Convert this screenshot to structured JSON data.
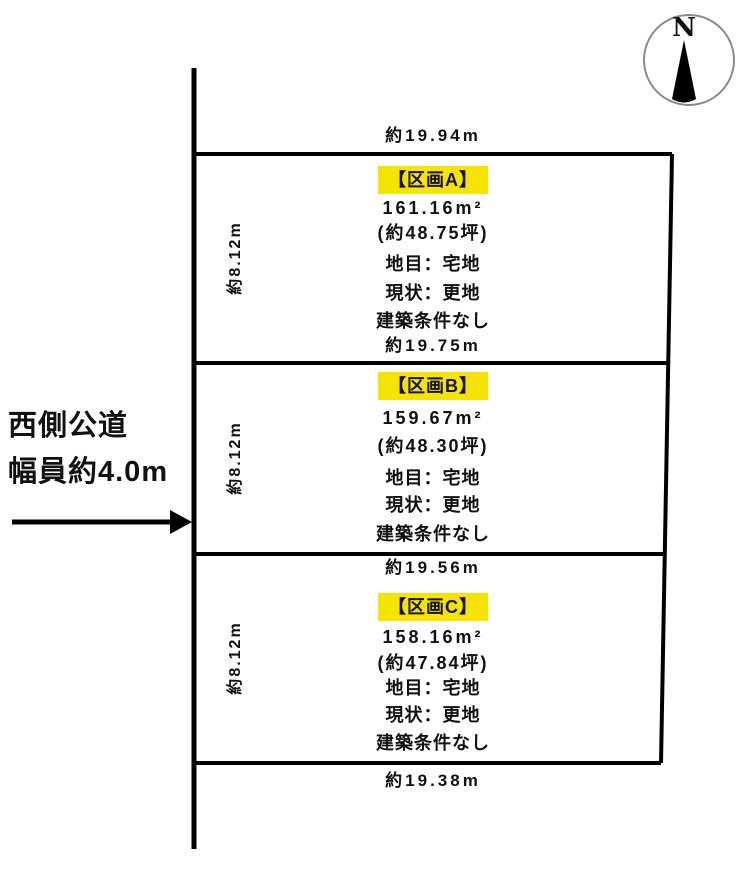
{
  "compass": {
    "label": "N"
  },
  "road": {
    "line1": "西側公道",
    "line2": "幅員約4.0m"
  },
  "frontage_top": "約19.94m",
  "plots": [
    {
      "label": "【区画A】",
      "area_sqm": "161.16m²",
      "area_tsubo": "(約48.75坪)",
      "land_category": "地目：宅地",
      "current_status": "現状：更地",
      "building_condition": "建築条件なし",
      "frontage": "約19.75m",
      "depth": "約8.12m"
    },
    {
      "label": "【区画B】",
      "area_sqm": "159.67m²",
      "area_tsubo": "(約48.30坪)",
      "land_category": "地目：宅地",
      "current_status": "現状：更地",
      "building_condition": "建築条件なし",
      "frontage": "約19.56m",
      "depth": "約8.12m"
    },
    {
      "label": "【区画C】",
      "area_sqm": "158.16m²",
      "area_tsubo": "(約47.84坪)",
      "land_category": "地目：宅地",
      "current_status": "現状：更地",
      "building_condition": "建築条件なし",
      "frontage": "約19.38m",
      "depth": "約8.12m"
    }
  ],
  "colors": {
    "highlight": "#f6e400",
    "line": "#000000",
    "text": "#111111"
  }
}
